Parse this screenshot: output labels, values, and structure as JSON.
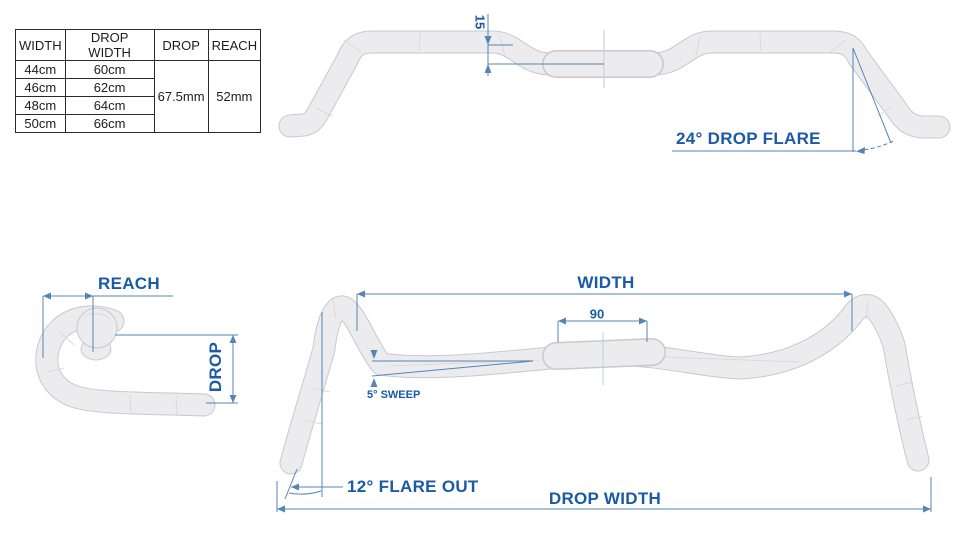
{
  "table": {
    "headers": [
      "WIDTH",
      "DROP WIDTH",
      "DROP",
      "REACH"
    ],
    "rows": [
      {
        "width": "44cm",
        "drop_width": "60cm"
      },
      {
        "width": "46cm",
        "drop_width": "62cm"
      },
      {
        "width": "48cm",
        "drop_width": "64cm"
      },
      {
        "width": "50cm",
        "drop_width": "66cm"
      }
    ],
    "drop": "67.5mm",
    "reach": "52mm"
  },
  "top_view": {
    "backsweep_label": "15",
    "flare_label": "24° DROP FLARE"
  },
  "side_view": {
    "reach_label": "REACH",
    "drop_label": "DROP"
  },
  "front_view": {
    "width_label": "WIDTH",
    "clamp_label": "90",
    "sweep_label": "5° SWEEP",
    "flare_out_label": "12° FLARE OUT",
    "drop_width_label": "DROP WIDTH"
  },
  "colors": {
    "accent_blue": "#1b5aa5",
    "dim_line_blue": "#5585b5",
    "bar_fill": "#ececee",
    "bar_outline": "#c7c9ce"
  }
}
